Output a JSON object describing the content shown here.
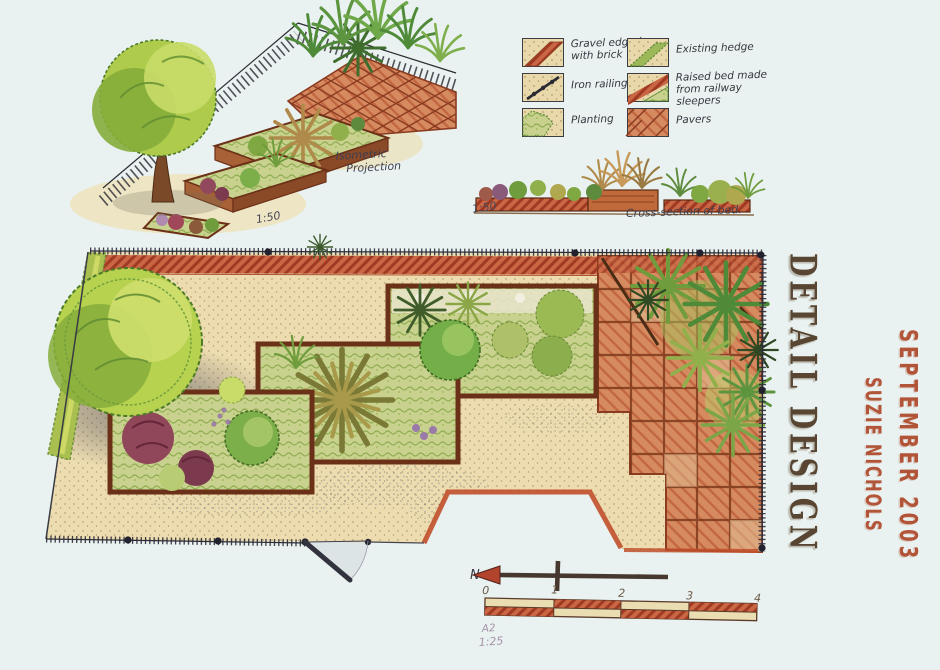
{
  "titles": {
    "main": "DETAIL DESIGN",
    "author": "SUZIE NICHOLS",
    "date": "SEPTEMBER 2003"
  },
  "legend": {
    "items": [
      {
        "name": "gravel-edged-with-brick",
        "label": "Gravel edged with brick"
      },
      {
        "name": "iron-railings",
        "label": "Iron railings"
      },
      {
        "name": "planting",
        "label": "Planting"
      },
      {
        "name": "existing-hedge",
        "label": "Existing hedge"
      },
      {
        "name": "railway-sleeper-raised-bed",
        "label": "Raised bed made from railway sleepers"
      },
      {
        "name": "pavers",
        "label": "Pavers"
      }
    ]
  },
  "isometric": {
    "label_line1": "Isometric",
    "label_line2": "Projection",
    "scale": "1:50"
  },
  "cross_section": {
    "label": "Cross-section of bed.",
    "scale": "1:50"
  },
  "plan": {
    "north_label": "N",
    "sheet_size": "A2",
    "scale": "1:25"
  },
  "scale_bar": {
    "ticks": [
      "0",
      "1",
      "2",
      "3",
      "4"
    ],
    "units_per_segment": 1,
    "segments": 4
  },
  "palette": {
    "title_brown": "#584633",
    "accent_terracotta": "#b25438",
    "brick_red": "#c14f2a",
    "paver_terracotta": "#d68a60",
    "gravel_tan": "#ecdcae",
    "foliage_light": "#b6d24f",
    "foliage_dark": "#6f9c3c",
    "ink": "#2c2c38",
    "background": "#e9f2f0"
  }
}
